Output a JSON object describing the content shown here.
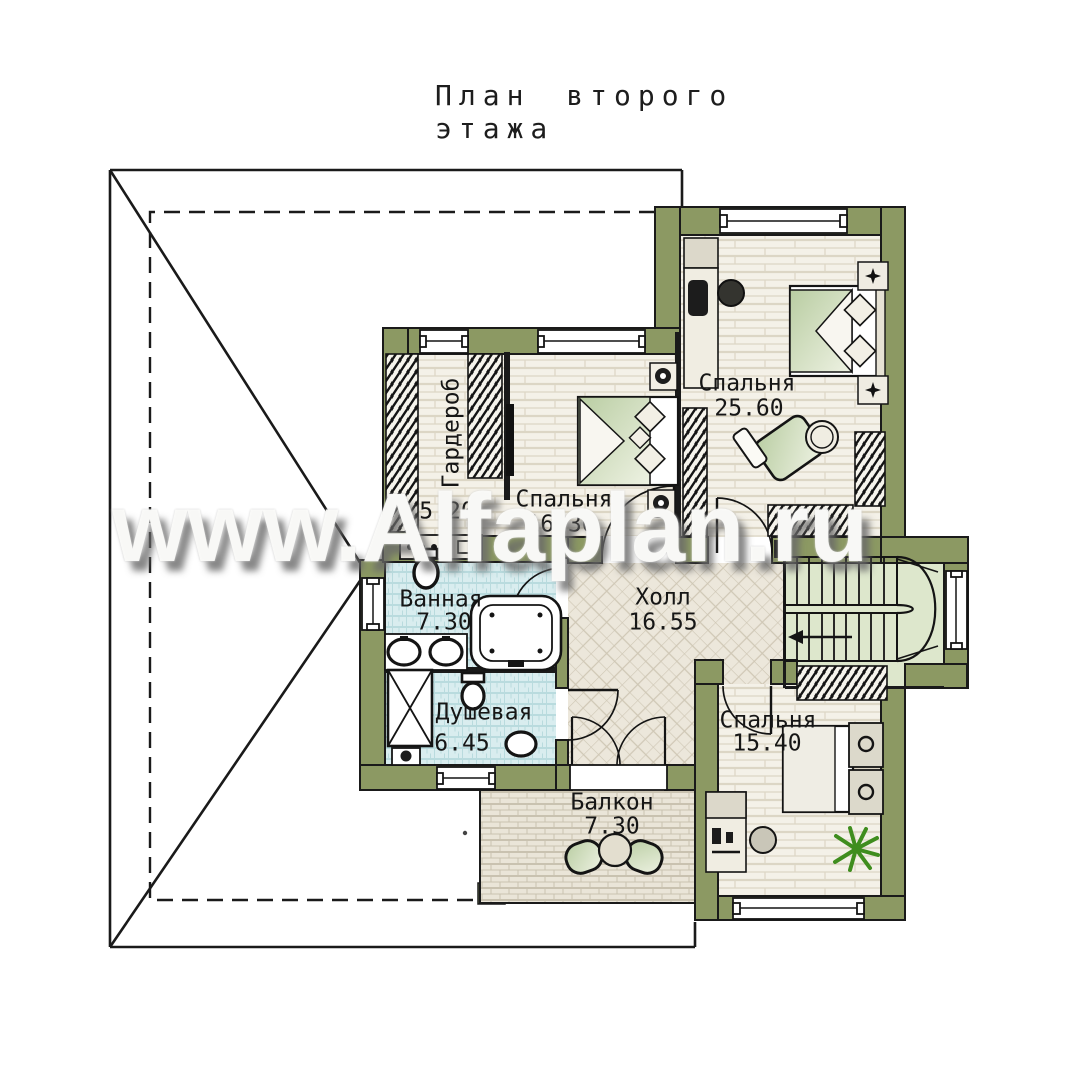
{
  "title": "План второго этажа",
  "watermark": "www.Alfaplan.ru",
  "rooms": [
    {
      "id": "bedroom-large",
      "name": "Спальня",
      "area": "25.60"
    },
    {
      "id": "wardrobe",
      "name": "Гардероб",
      "area": "5.20"
    },
    {
      "id": "bedroom-middle",
      "name": "Спальня",
      "area": "16.30"
    },
    {
      "id": "bathroom",
      "name": "Ванная",
      "area": "7.30"
    },
    {
      "id": "shower",
      "name": "Душевая",
      "area": "6.45"
    },
    {
      "id": "hall",
      "name": "Холл",
      "area": "16.55"
    },
    {
      "id": "bedroom-small",
      "name": "Спальня",
      "area": "15.40"
    },
    {
      "id": "balcony",
      "name": "Балкон",
      "area": "7.30"
    }
  ],
  "colors": {
    "wall_green": "#8c9963",
    "line_black": "#1a1a1a",
    "bath_tile": "#d9edef",
    "hall_tile": "#ece7db",
    "plank_floor": "#f4f1e8",
    "stair_floor": "#dde7cc",
    "paver": "#eae5d8",
    "plant_green": "#3f8d1e"
  }
}
